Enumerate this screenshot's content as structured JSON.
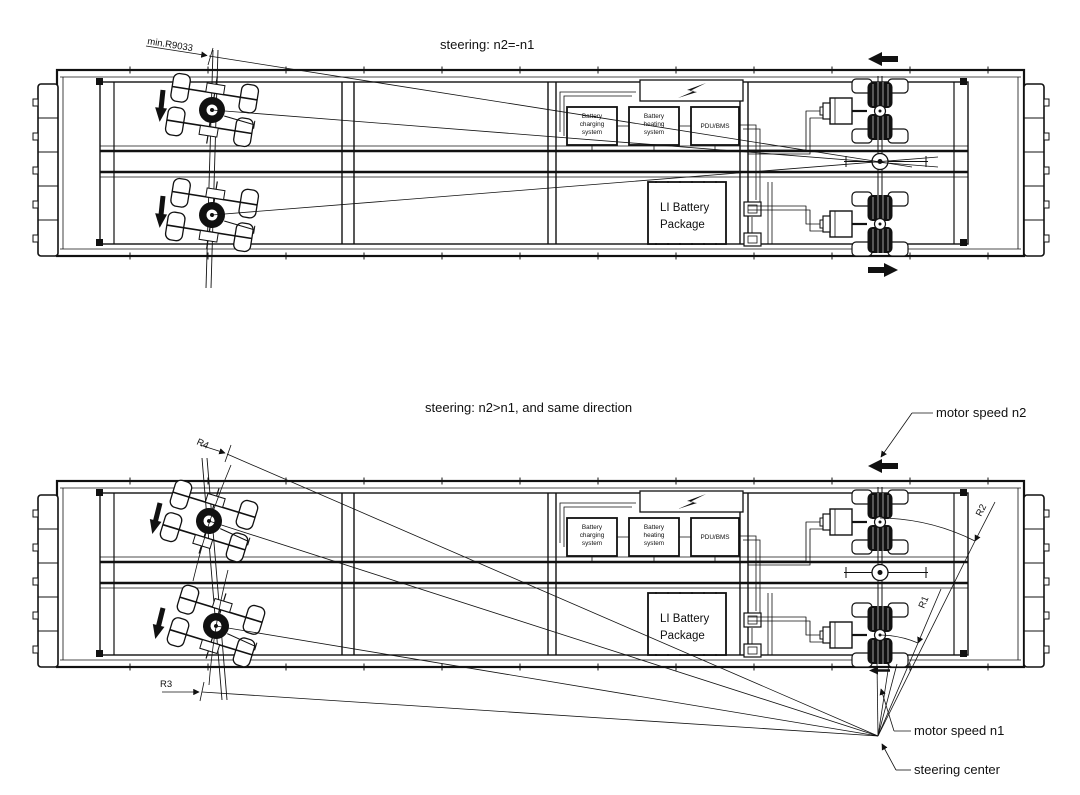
{
  "drawing": {
    "background": "#ffffff",
    "line_color": "#111111",
    "top_view": {
      "title": "steering: n2=-n1",
      "min_radius_label": "min.R9033"
    },
    "bottom_view": {
      "title": "steering: n2>n1, and  same direction",
      "r1": "R1",
      "r2": "R2",
      "r3": "R3",
      "r4": "R4",
      "motor_speed_n2": "motor speed n2",
      "motor_speed_n1": "motor speed n1",
      "steering_center": "steering center"
    },
    "equipment": {
      "battery_charging": [
        "Battery",
        "charging",
        "system"
      ],
      "battery_heating": [
        "Battery",
        "heating",
        "system"
      ],
      "pdu_bms": "PDU/BMS",
      "li_battery": [
        "LI Battery",
        "Package"
      ]
    }
  }
}
